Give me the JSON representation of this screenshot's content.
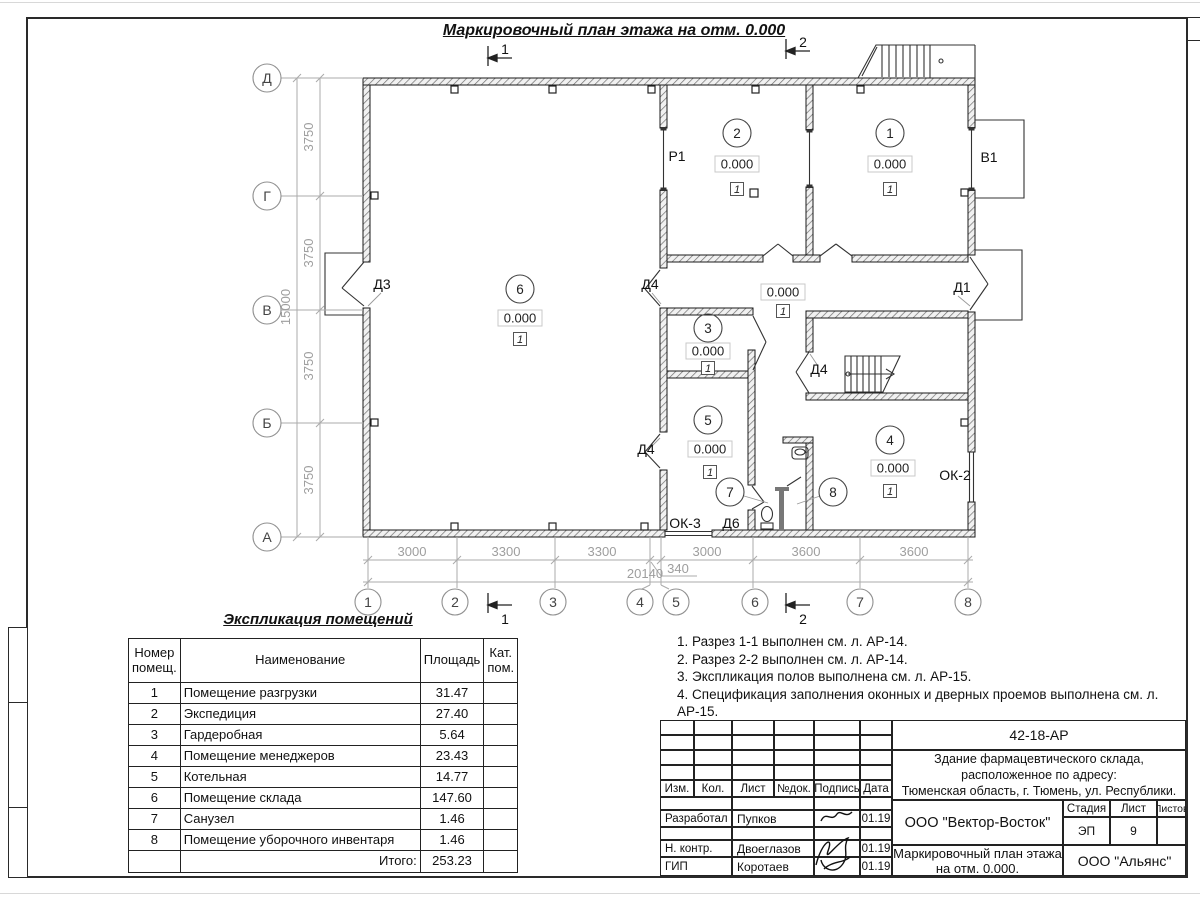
{
  "sheet": {
    "title": "Маркировочный план этажа на отм. 0.000"
  },
  "plan": {
    "axes_rows": [
      "Д",
      "Г",
      "В",
      "Б",
      "А"
    ],
    "axes_cols": [
      "1",
      "2",
      "3",
      "4",
      "5",
      "6",
      "7",
      "8"
    ],
    "dims_left": [
      "3750",
      "3750",
      "3750",
      "3750"
    ],
    "dim_left_total": "15000",
    "dims_bottom": [
      "3000",
      "3300",
      "3300",
      "3000",
      "3600",
      "3600"
    ],
    "dim_bottom_total": "20140",
    "dim_bottom_extra": "340",
    "section_1": "1",
    "section_2": "2",
    "labels": {
      "d1": "Д1",
      "d3": "Д3",
      "d4": "Д4",
      "d6": "Д6",
      "r1": "Р1",
      "v1": "В1",
      "ok2": "ОК-2",
      "ok3": "ОК-3"
    },
    "rooms": [
      {
        "number": "1",
        "elevation": "0.000",
        "floor": "1"
      },
      {
        "number": "2",
        "elevation": "0.000",
        "floor": "1"
      },
      {
        "number": "3",
        "elevation": "0.000",
        "floor": "1"
      },
      {
        "number": "4",
        "elevation": "0.000",
        "floor": "1"
      },
      {
        "number": "5",
        "elevation": "0.000",
        "floor": "1"
      },
      {
        "number": "6",
        "elevation": "0.000",
        "floor": "1"
      },
      {
        "number": "7"
      },
      {
        "number": "8"
      }
    ],
    "corridor": {
      "elevation": "0.000",
      "floor": "1"
    }
  },
  "schedule": {
    "title": "Экспликация помещений",
    "headers": [
      "Номер помещ.",
      "Наименование",
      "Площадь",
      "Кат. пом."
    ],
    "rows": [
      {
        "num": "1",
        "name": "Помещение разгрузки",
        "area": "31.47",
        "cat": ""
      },
      {
        "num": "2",
        "name": "Экспедиция",
        "area": "27.40",
        "cat": ""
      },
      {
        "num": "3",
        "name": "Гардеробная",
        "area": "5.64",
        "cat": ""
      },
      {
        "num": "4",
        "name": "Помещение менеджеров",
        "area": "23.43",
        "cat": ""
      },
      {
        "num": "5",
        "name": "Котельная",
        "area": "14.77",
        "cat": ""
      },
      {
        "num": "6",
        "name": "Помещение склада",
        "area": "147.60",
        "cat": ""
      },
      {
        "num": "7",
        "name": "Санузел",
        "area": "1.46",
        "cat": ""
      },
      {
        "num": "8",
        "name": "Помещение уборочного инвентаря",
        "area": "1.46",
        "cat": ""
      }
    ],
    "total_label": "Итого:",
    "total": "253.23"
  },
  "notes": [
    "1. Разрез 1-1 выполнен см. л. АР-14.",
    "2. Разрез 2-2 выполнен см. л. АР-14.",
    "3. Экспликация полов выполнена см. л. АР-15.",
    "4. Спецификация заполнения оконных и дверных проемов выполнена см. л. АР-15."
  ],
  "titleblock": {
    "doc_number": "42-18-АР",
    "object_line1": "Здание фармацевтического склада, расположенное по адресу:",
    "object_line2": "Тюменская область, г. Тюмень, ул. Республики.",
    "columns": [
      "Изм.",
      "Кол.",
      "Лист",
      "№док.",
      "Подпись",
      "Дата"
    ],
    "signers": [
      {
        "role": "Разработал",
        "name": "Пупков",
        "date": "01.19"
      },
      {
        "role": "Н. контр.",
        "name": "Двоеглазов",
        "date": "01.19"
      },
      {
        "role": "ГИП",
        "name": "Коротаев",
        "date": "01.19"
      }
    ],
    "org_design": "ООО \"Вектор-Восток\"",
    "org_customer": "ООО \"Альянс\"",
    "stage_label": "Стадия",
    "sheet_label": "Лист",
    "sheets_label": "Листов",
    "stage": "ЭП",
    "sheet_number": "9",
    "sheets_total": "",
    "title_line1": "Маркировочный план этажа",
    "title_line2": "на отм. 0.000."
  }
}
